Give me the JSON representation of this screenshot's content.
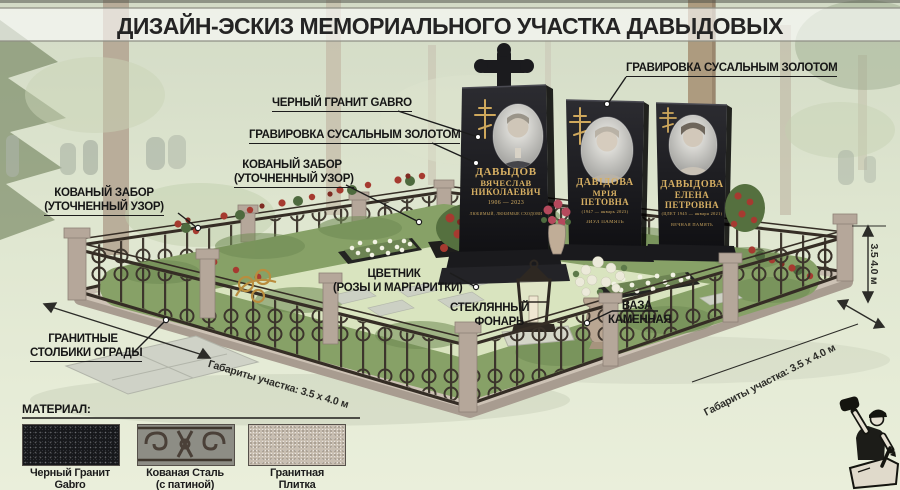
{
  "title": "ДИЗАЙН-ЭСКИЗ МЕМОРИАЛЬНОГО УЧАСТКА ДАВЫДОВЫХ",
  "callouts": {
    "black_granite": "ЧЕРНЫЙ ГРАНИТ GABRO",
    "engraving_left": "ГРАВИРОВКА СУСАЛЬНЫМ ЗОЛОТОМ",
    "engraving_right": "ГРАВИРОВКА СУСАЛЬНЫМ ЗОЛОТОМ",
    "fence_center_line1": "КОВАНЫЙ ЗАБОР",
    "fence_center_line2": "(УТОЧНЕННЫЙ УЗОР)",
    "fence_left_line1": "КОВАНЫЙ ЗАБОР",
    "fence_left_line2": "(УТОЧНЕННЫЙ УЗОР)",
    "flowerbed_line1": "ЦВЕТНИК",
    "flowerbed_line2": "(РОЗЫ И МАРГАРИТКИ)",
    "lantern_line1": "СТЕКЛЯННЫЙ",
    "lantern_line2": "ФОНАРЬ",
    "vase_line1": "ВАЗА",
    "vase_line2": "КАМЕННАЯ",
    "posts_line1": "ГРАНИТНЫЕ",
    "posts_line2": "СТОЛБИКИ ОГРАДЫ"
  },
  "dimensions": {
    "plot_front_left": "Габариты участка: 3.5 х 4.0 м",
    "plot_front_right": "Габариты участка: 3.5 х 4.0 м",
    "plot_height_right": "3.5 4.0 м"
  },
  "monuments": [
    {
      "surname": "ДАВЫДОВ",
      "firstname": "ВЯЧЕСЛАВ",
      "patronymic": "НИКОЛАЕВИЧ",
      "dates": "1906 — 2023",
      "epitaph": "ЛЮБИМЫЙ, ЛЮБИМЫЕ СХОДОВИ"
    },
    {
      "surname": "ДАВІДОВА",
      "firstname": "МРІЯ",
      "patronymic": "ПЕТОВНА",
      "dates": "(1947 — январь 2023)",
      "epitaph": "ЗИУЛ ПАМЯТЬ"
    },
    {
      "surname": "ДАВЫДОВА",
      "firstname": "ЕЛЕНА",
      "patronymic": "ПЕТРОВНА",
      "dates": "(ЦЛЕТ 1945 — января 2021)",
      "epitaph": "ВЕЧНАЯ ПАМЯТЬ"
    }
  ],
  "materials": {
    "heading": "МАТЕРИАЛ:",
    "items": [
      {
        "line1": "Черный Гранит",
        "line2": "Gabro"
      },
      {
        "line1": "Кованая Сталь",
        "line2": "(с патиной)"
      },
      {
        "line1": "Гранитная",
        "line2": "Плитка"
      }
    ]
  },
  "colors": {
    "gold_engraving": "#d6af63",
    "monument_black": "#1b1b1e",
    "hedge_green": "#87a167",
    "rose_red": "#a63a30",
    "iron_dark": "#3a322a",
    "granite_post": "#b5a79a"
  }
}
